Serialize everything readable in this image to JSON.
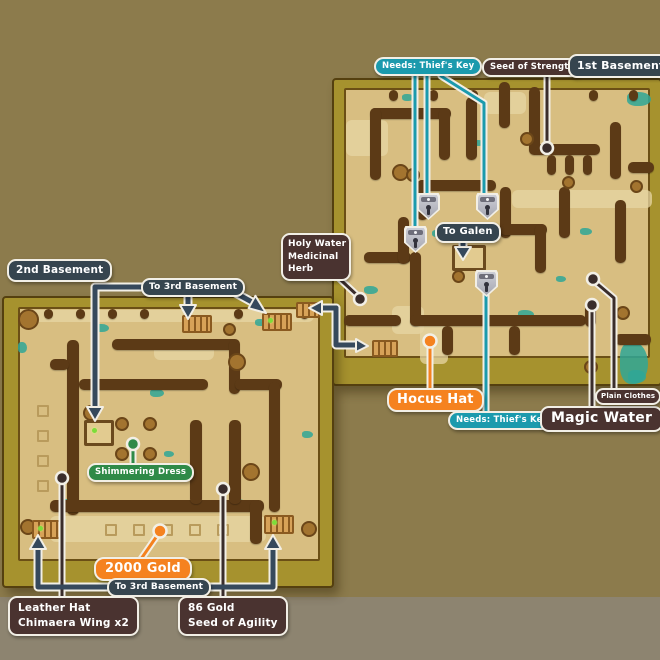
{
  "maps": {
    "first_basement": {
      "title": "1st Basement",
      "labels": {
        "needs_thiefs_key_top": "Needs: Thief's Key",
        "seed_of_strength": "Seed of Strength",
        "to_galen": "To Galen",
        "holy_water": "Holy Water",
        "medicinal_herb": "Medicinal Herb",
        "hocus_hat": "Hocus Hat",
        "needs_thiefs_key_bottom": "Needs: Thief's Key",
        "magic_water": "Magic Water",
        "plain_clothes": "Plain Clothes"
      },
      "icons": {
        "lock": "thiefs-key-lock",
        "lock_count": 4
      }
    },
    "second_basement": {
      "title": "2nd Basement",
      "labels": {
        "to_3rd_basement_top": "To 3rd Basement",
        "shimmering_dress": "Shimmering Dress",
        "gold_2000": "2000 Gold",
        "to_3rd_basement_bottom": "To 3rd Basement",
        "leather_hat": "Leather Hat",
        "chimaera_wing": "Chimaera Wing x2",
        "gold_86": "86 Gold",
        "seed_of_agility": "Seed of Agility"
      }
    }
  },
  "colors": {
    "needs_key_teal": "#1b9aad",
    "location_navy": "#36454f",
    "item_brown": "#4a3330",
    "highlight_orange": "#f5821f",
    "item_green": "#2f8a48",
    "map_floor": "#d8be81",
    "map_wall": "#5c3a16",
    "map_border_olive": "#a6922e",
    "background": "#8c7b4c"
  }
}
